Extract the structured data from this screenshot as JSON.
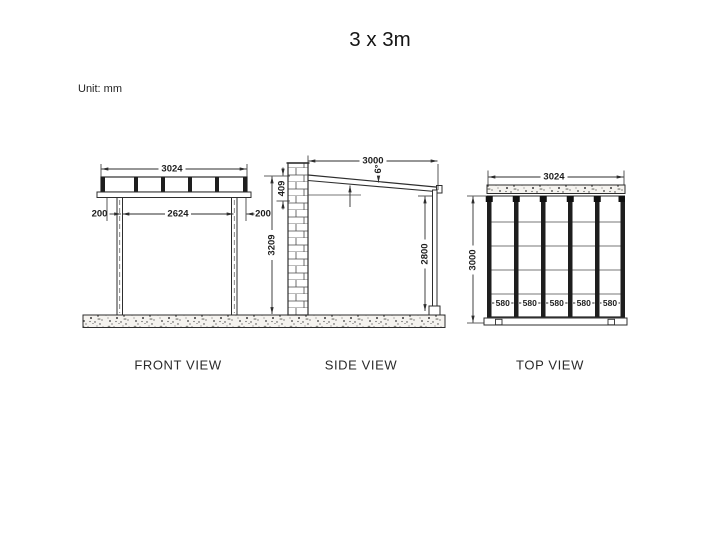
{
  "title": "3 x 3m",
  "unit_note": "Unit: mm",
  "views": {
    "front": {
      "label": "FRONT VIEW",
      "dims": {
        "overall_width": "3024",
        "left_overhang": "200",
        "post_spacing": "2624",
        "right_overhang": "200"
      }
    },
    "side": {
      "label": "SIDE VIEW",
      "dims": {
        "depth": "3000",
        "wall_roof_drop": "409",
        "total_height": "3209",
        "roof_angle": "6°",
        "post_height": "2800"
      }
    },
    "top": {
      "label": "TOP VIEW",
      "dims": {
        "overall_width": "3024",
        "overall_depth": "3000",
        "panel_widths": [
          "580",
          "580",
          "580",
          "580",
          "580"
        ]
      }
    }
  },
  "colors": {
    "line": "#2e2e2e",
    "text": "#1d1d1d",
    "background": "#ffffff",
    "texture_fill": "#f5f3ef"
  }
}
